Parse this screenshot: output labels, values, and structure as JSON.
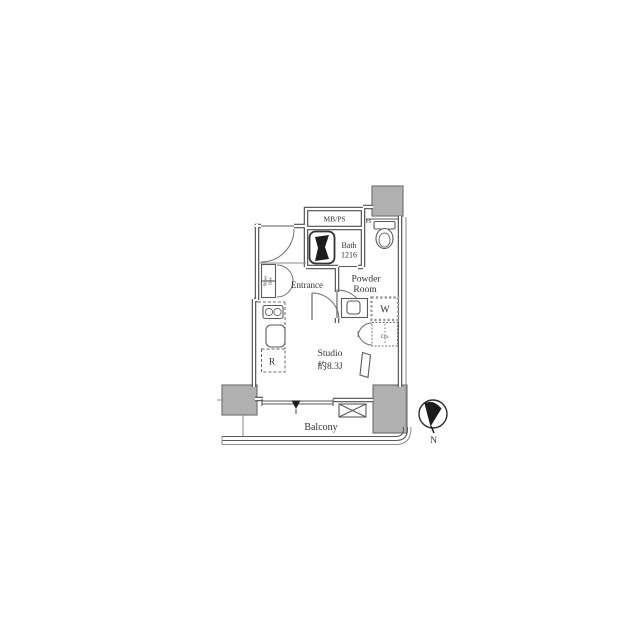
{
  "floor_plan": {
    "labels": {
      "mbps": "MB/PS",
      "ps": "PS",
      "bath": [
        "Bath",
        "1216"
      ],
      "entrance": "Entrance",
      "powder_room": [
        "Powder",
        "Room"
      ],
      "washer": "W",
      "closet": "Clo.",
      "shoes_box": [
        "Shoes",
        "Box"
      ],
      "refrigerator": "R",
      "studio": [
        "Studio",
        "約8.3J"
      ],
      "balcony": "Balcony"
    },
    "compass": {
      "north": "N"
    },
    "colors": {
      "wall": "#4d4d4d",
      "line": "#5a5a5a",
      "pillar_fill": "#b0b0b0",
      "fixture_black": "#1c1c1c",
      "text": "#333333",
      "background": "#ffffff"
    }
  }
}
